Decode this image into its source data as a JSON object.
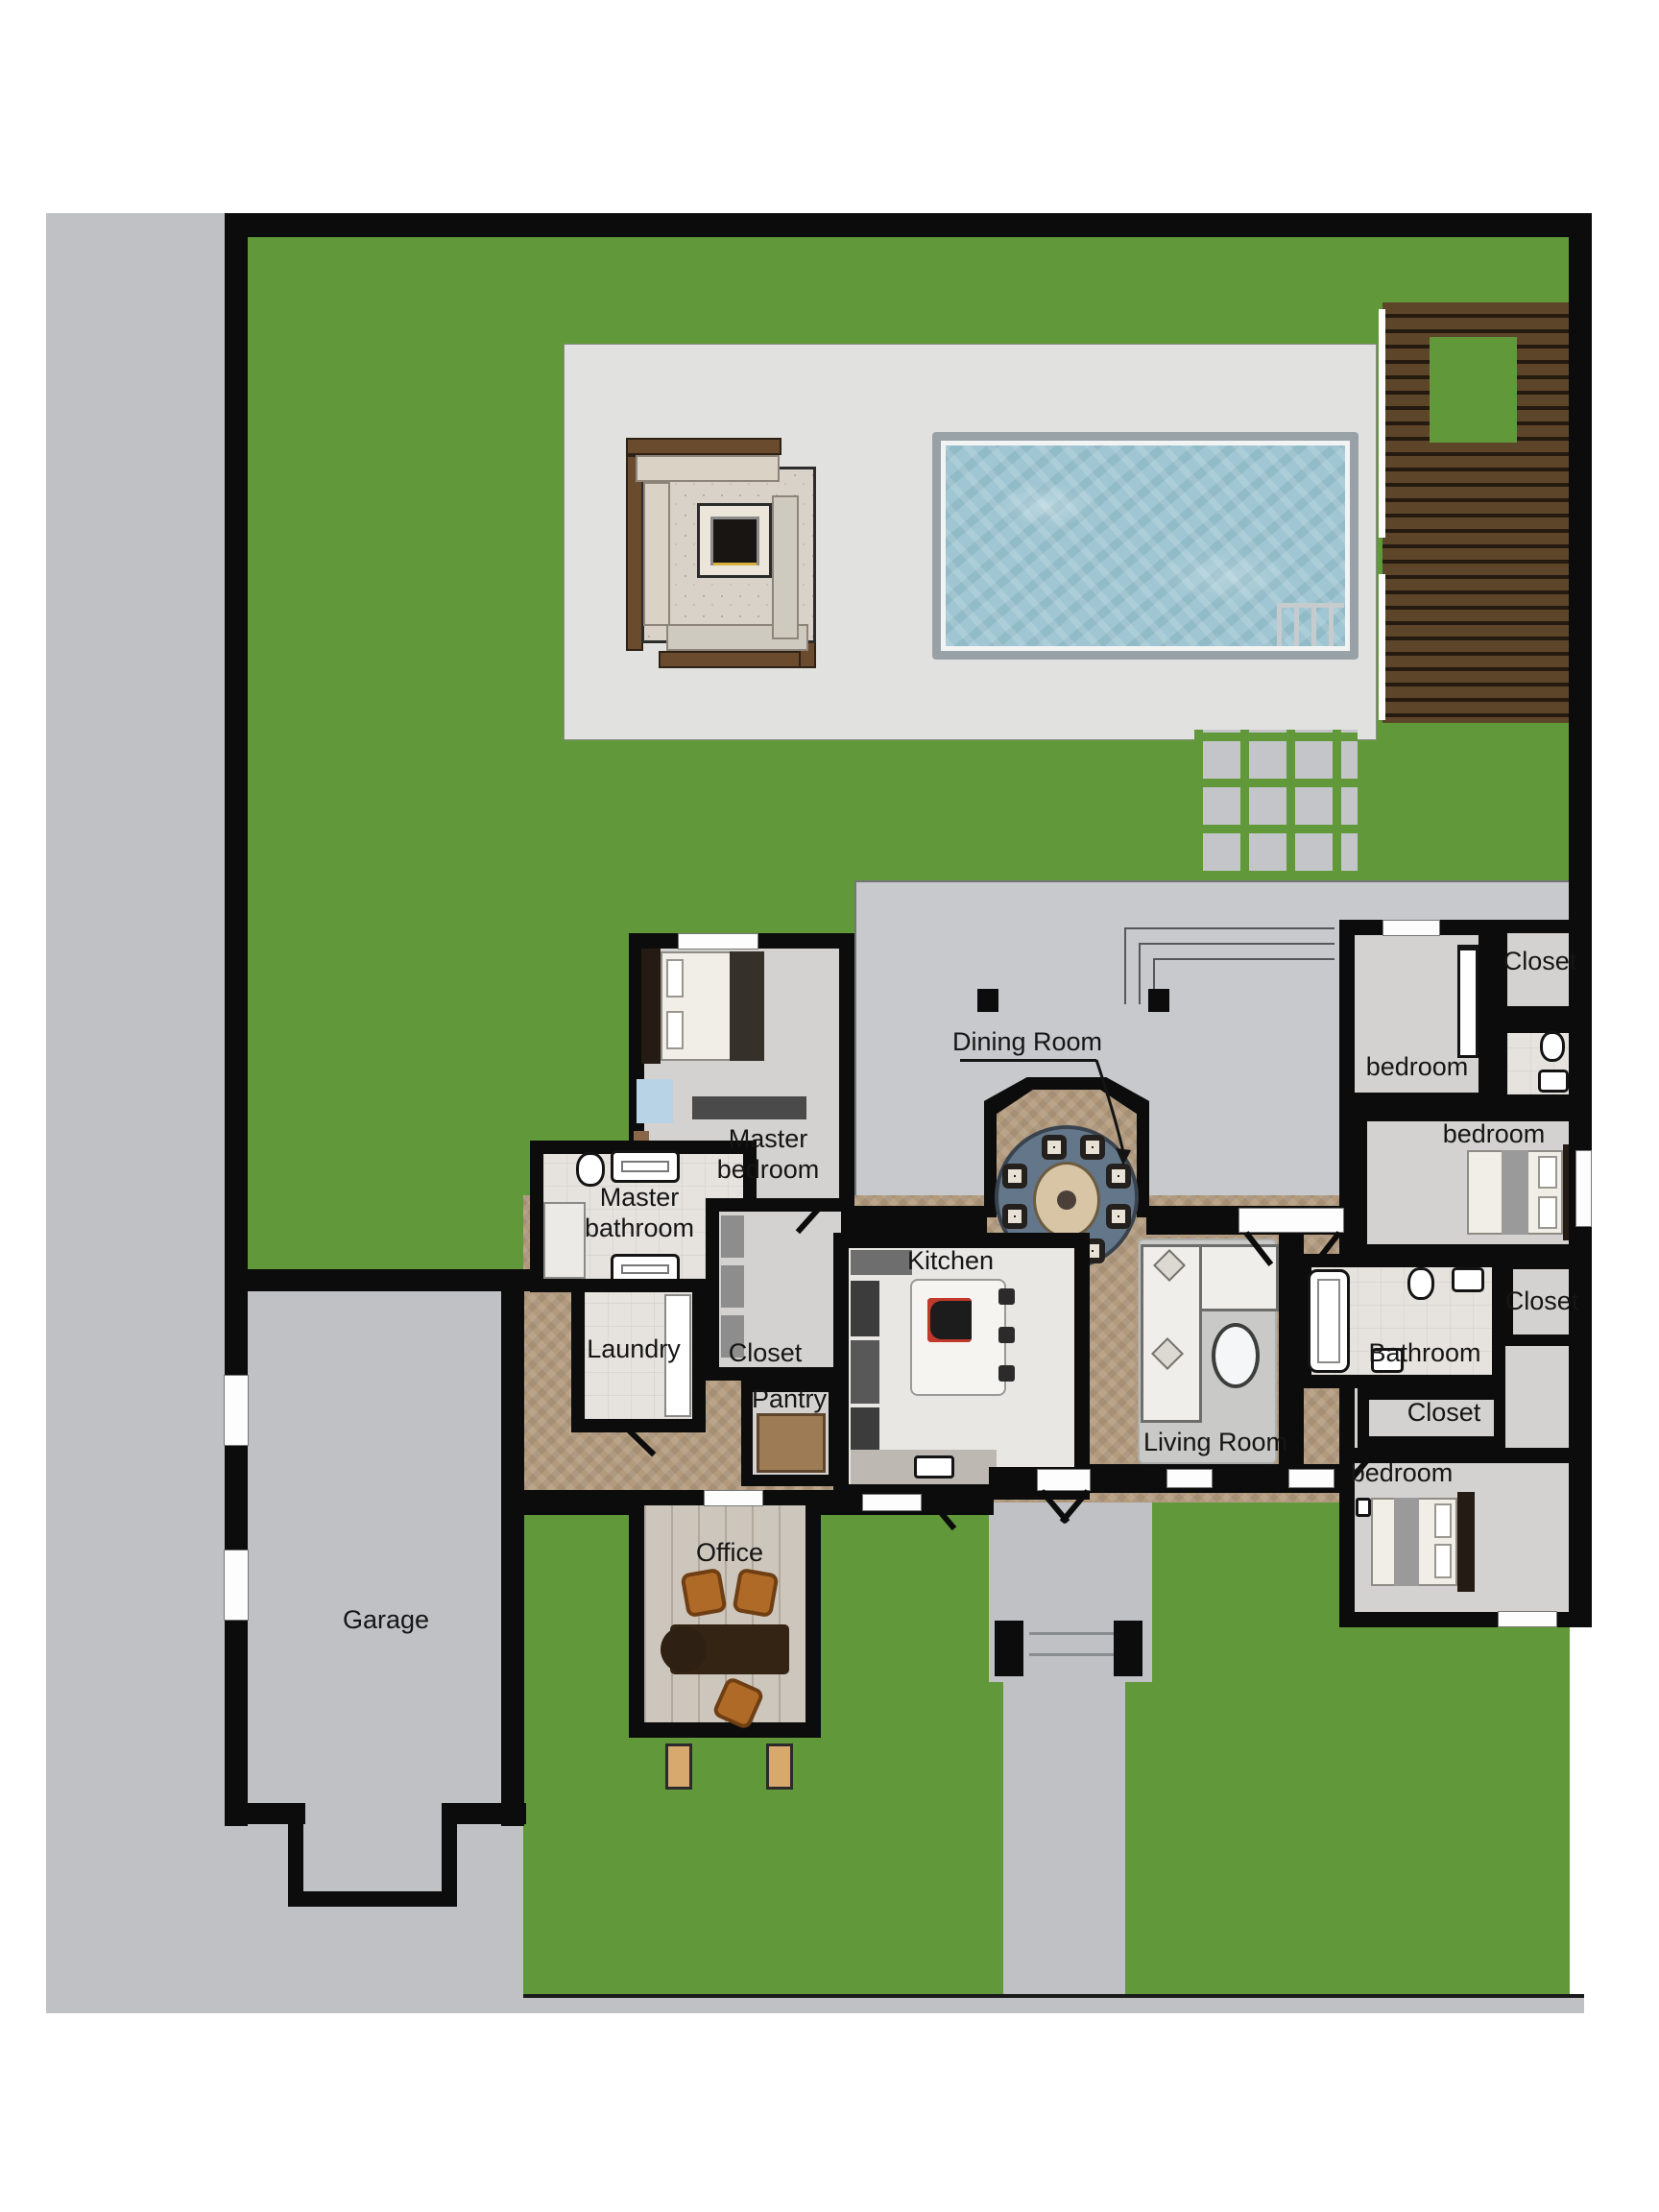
{
  "title": "Residential floor plan with yard, pool and garage",
  "labels": {
    "garage": "Garage",
    "office": "Office",
    "kitchen": "Kitchen",
    "pantry": "Pantry",
    "laundry": "Laundry",
    "master_closet": "Closet",
    "master_bedroom": "Master bedroom",
    "master_bathroom": "Master bathroom",
    "dining_room": "Dining Room",
    "living_room": "Living Room",
    "bedroom_top": "bedroom",
    "closet_top_right": "Closet",
    "bedroom_middle": "bedroom",
    "closet_middle_right": "Closet",
    "bathroom": "Bathroom",
    "closet_hall": "Closet",
    "bedroom_bottom": "bedroom"
  },
  "colors": {
    "lawn": "#61993a",
    "pavement": "#bfc1c5",
    "back_patio": "#c7c9cc",
    "pool_deck": "#e1e1df",
    "pool_water": "#9fc6d2",
    "walls": "#0c0c0c",
    "wood_deck_plank": "#5d4529",
    "interior_floor": "#d3d2d0",
    "tile_floor": "#e6e3df",
    "hall_wood_floor": "#b29a7d",
    "dining_rug": "#64778a",
    "living_rug": "#c9c9c7"
  }
}
